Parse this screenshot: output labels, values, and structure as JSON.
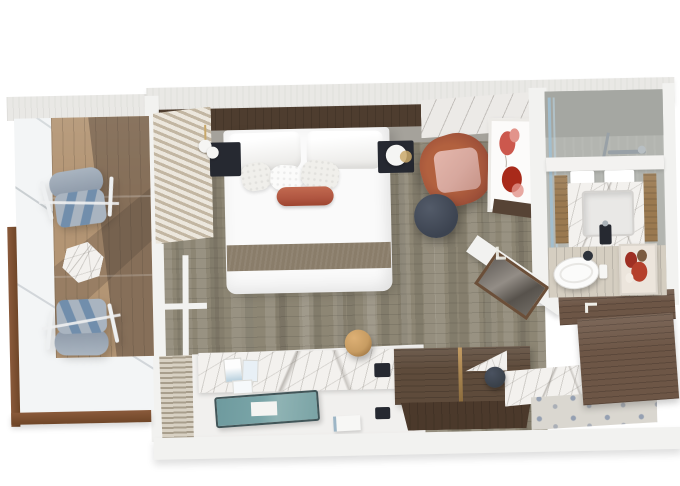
{
  "meta": {
    "alt": "Top-down 3D render of a ship stateroom floor plan: balcony with two deck chairs and side table, bedroom with double bed, nightstands with pendant lamps, rust armchair, round side table, poppy wall art, desk with teal tray, wood bench, and a bathroom with shower, marble vanity sink, toilet and wall art, plus entry hall with wardrobe and mosaic floor",
    "width": 680,
    "height": 486
  },
  "colors": {
    "canvas": "#ffffff",
    "outer-wall": "#e9e8e5",
    "wall-white": "#f2f2f0",
    "frame-wood": "#8a5a3b",
    "frame-wood-dark": "#6f4628",
    "glass": "#f3f5f6",
    "deck-wood": "#b39574",
    "deck-shadow": "rgba(72,60,52,0.42)",
    "chair-cushion": "#a9b4c0",
    "chair-cushion-dark": "#8d99a8",
    "chair-stripe": "#5f82a6",
    "chair-frame": "#eef0f1",
    "carpet": "#8d8674",
    "headboard-wood": "#4e3d2f",
    "headboard-pad": "#a5a29b",
    "bed-white": "#fafafa",
    "pillow-shade": "#e7e6e3",
    "runner": "#8a7d6a",
    "bolster": "#b05641",
    "nightstand": "#262931",
    "lamp-white": "#f5f5f3",
    "lamp-gold": "#c9a86a",
    "armchair": "#a0523a",
    "armchair-cushion": "#d7a89e",
    "side-table": "#3c4350",
    "art-bg": "#fcfbfa",
    "poppy-red": "#c7463a",
    "poppy-pink": "#e2948b",
    "poppy-deep": "#a82a1a",
    "blind-light": "#ece7dd",
    "blind-dark": "#c2b6a2",
    "grille-light": "#d8d1c3",
    "grille-dark": "#a89e8c",
    "desk-top": "#f1f0ee",
    "marble": "#f3f1ee",
    "tray": "#7aa5a8",
    "tray-rim": "#415558",
    "sphere": "#c79c62",
    "bench-top": "#5e4b3b",
    "bench-front": "#4b392b",
    "groove-gold": "#c39c63",
    "entry-wood": "#6d5646",
    "entry-floor": "#dad7d0",
    "mosaic-dot": "#95a0b2",
    "shower-wall": "#b3b5b0",
    "shower-wall-dark": "#a5a7a2",
    "glass-blue": "#9fc0d4",
    "chrome": "#99a1a7",
    "bath-floor": "#d5cec1",
    "vanity-wood": "#9a7950",
    "toilet": "#fbfbfa",
    "stool": "#394049",
    "bath-art-red": "#9e2f23",
    "bath-art-brown": "#7b5b40"
  },
  "inventory": {
    "balcony": [
      "glass-balustrade",
      "teak-deck",
      "deck-chair",
      "deck-chair",
      "hex-side-table"
    ],
    "bedroom": [
      "double-bed",
      "pillows",
      "accent-bolster",
      "bed-runner",
      "nightstand-left",
      "pendant-lamp",
      "nightstand-right",
      "table-lamp",
      "armchair",
      "round-side-table",
      "poppy-artwork",
      "vertical-blinds",
      "window-mullions",
      "floor-vent-grille",
      "carpet"
    ],
    "desk-area": [
      "desk",
      "marble-backsplash",
      "postcards",
      "power-outlets",
      "teal-tray",
      "white-book",
      "wood-sphere",
      "wood-bench"
    ],
    "bathroom": [
      "shower",
      "glass-partition",
      "shower-fixture",
      "towels",
      "marble-vanity",
      "sink",
      "faucet",
      "toilet",
      "abstract-artwork",
      "plank-floor"
    ],
    "entry": [
      "diagonal-wall",
      "framed-mirror",
      "wardrobe-wood-wall",
      "mosaic-floor",
      "dark-stools",
      "door-frame-marks"
    ]
  }
}
